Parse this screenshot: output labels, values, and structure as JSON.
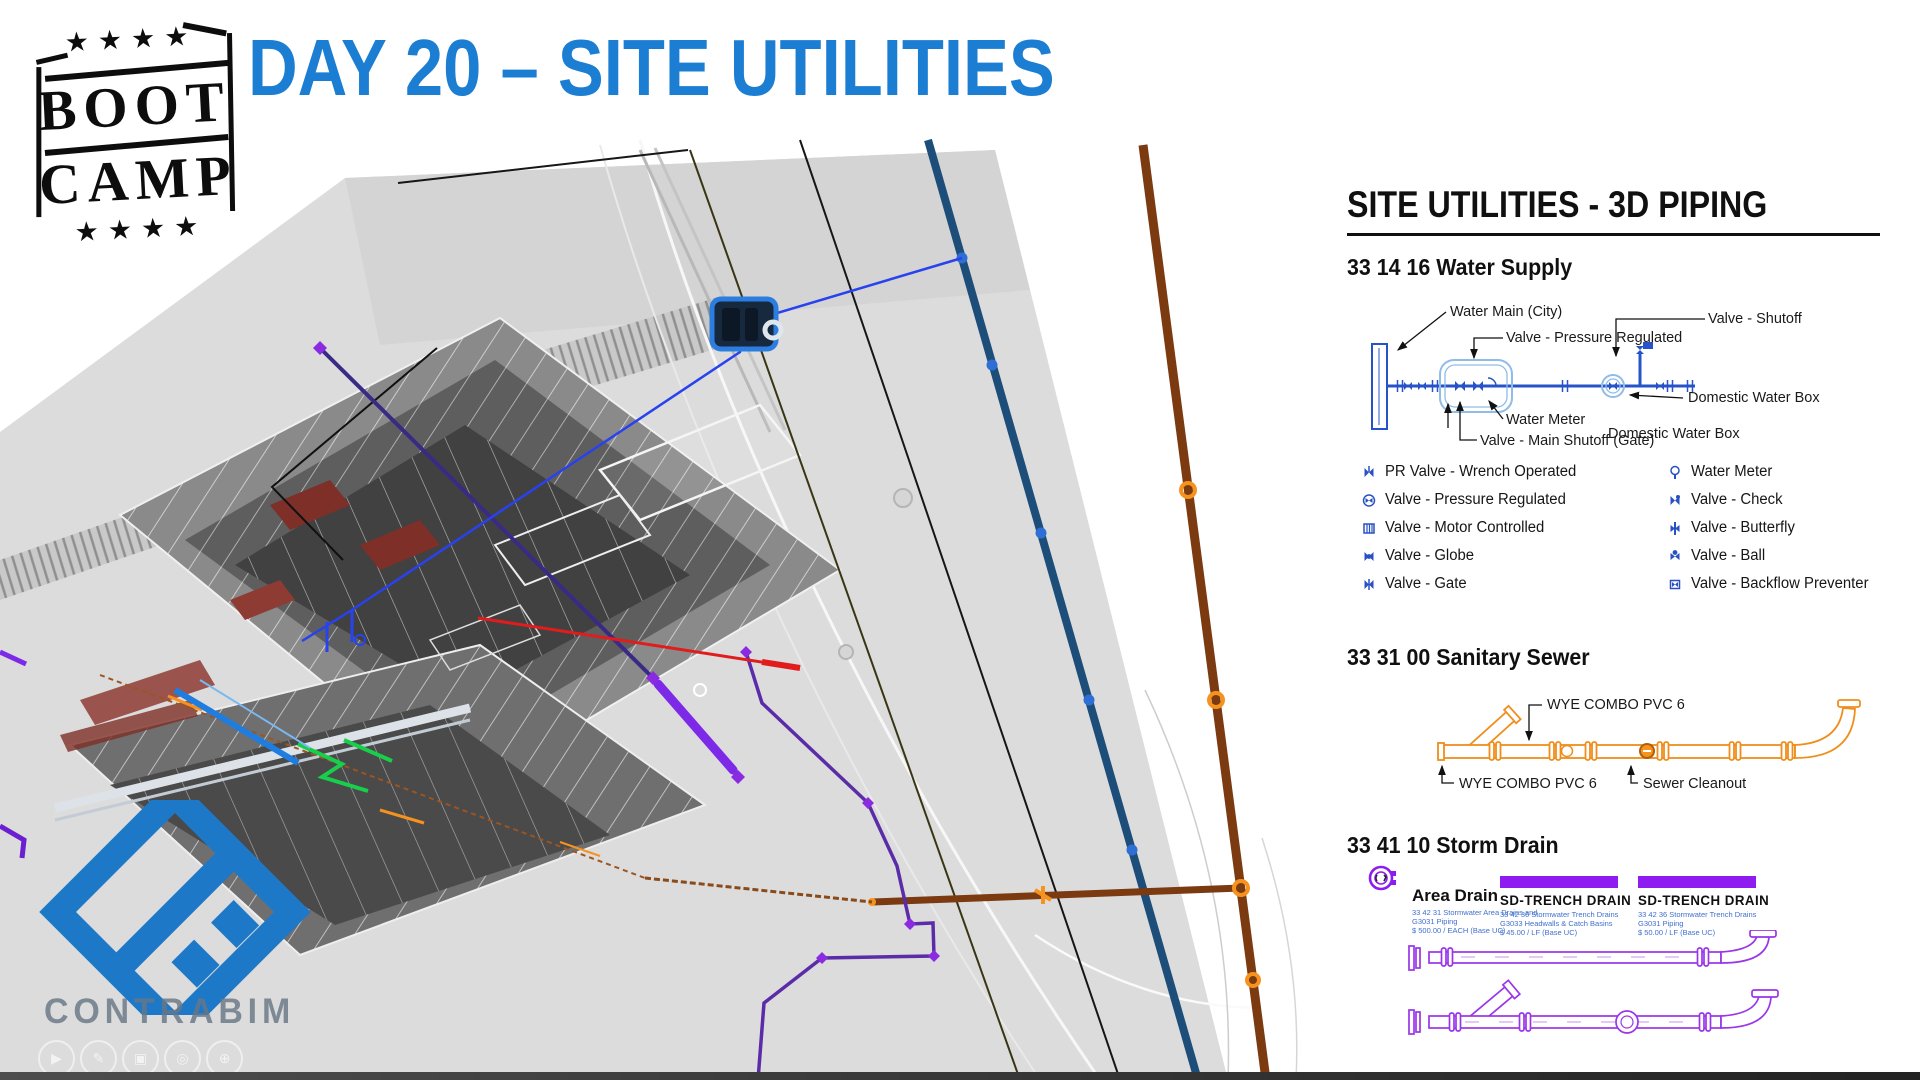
{
  "colors": {
    "title_blue": "#1b7ed2",
    "water_blue": "#2742ee",
    "navy_pipe": "#1d4e79",
    "sewer_brown": "#7b3a10",
    "fitting_orange": "#f6921e",
    "sanitary_orange": "#ef8e1c",
    "storm_purple": "#8e1cf0",
    "diagram_blue": "#2753c8",
    "brand_blue": "#1e78c8"
  },
  "slide": {
    "title": "DAY 20 – SITE UTILITIES"
  },
  "stamp": {
    "stars_top": "★★★★",
    "line1": "BOOT",
    "line2": "CAMP",
    "stars_bottom": "★★★★"
  },
  "brand": {
    "name": "CONTRABIM"
  },
  "panel": {
    "title": "SITE UTILITIES - 3D PIPING",
    "water_supply": {
      "heading": "33 14 16 Water Supply",
      "labels": {
        "water_main": "Water Main (City)",
        "valve_pr": "Valve - Pressure Regulated",
        "valve_shutoff": "Valve - Shutoff",
        "domestic_water_box": "Domestic Water Box",
        "water_meter": "Water Meter",
        "valve_main_shutoff": "Valve - Main Shutoff (Gate)",
        "domestic_water_box_2": "Domestic Water Box"
      },
      "legend_left": [
        "PR Valve - Wrench Operated",
        "Valve - Pressure Regulated",
        "Valve - Motor Controlled",
        "Valve - Globe",
        "Valve - Gate"
      ],
      "legend_right": [
        "Water Meter",
        "Valve - Check",
        "Valve - Butterfly",
        "Valve - Ball",
        "Valve - Backflow Preventer"
      ]
    },
    "sanitary": {
      "heading": "33 31 00 Sanitary Sewer",
      "label_top": "WYE COMBO PVC 6",
      "label_bottom_left": "WYE COMBO PVC 6",
      "label_bottom_right": "Sewer Cleanout"
    },
    "storm": {
      "heading": "33 41 10 Storm Drain",
      "area_drain": {
        "label": "Area Drain",
        "line1": "33 42 31 Stormwater Area Drains and",
        "line2": "G3031 Piping",
        "line3": "$ 500.00 / EACH (Base UC)"
      },
      "trench_1": {
        "label": "SD-TRENCH DRAIN",
        "line1": "33 42 36 Stormwater Trench Drains",
        "line2": "G3033 Headwalls & Catch Basins",
        "line3": "$ 45.00 / LF (Base UC)"
      },
      "trench_2": {
        "label": "SD-TRENCH DRAIN",
        "line1": "33 42 36 Stormwater Trench Drains",
        "line2": "G3031 Piping",
        "line3": "$ 50.00 / LF (Base UC)"
      }
    }
  }
}
